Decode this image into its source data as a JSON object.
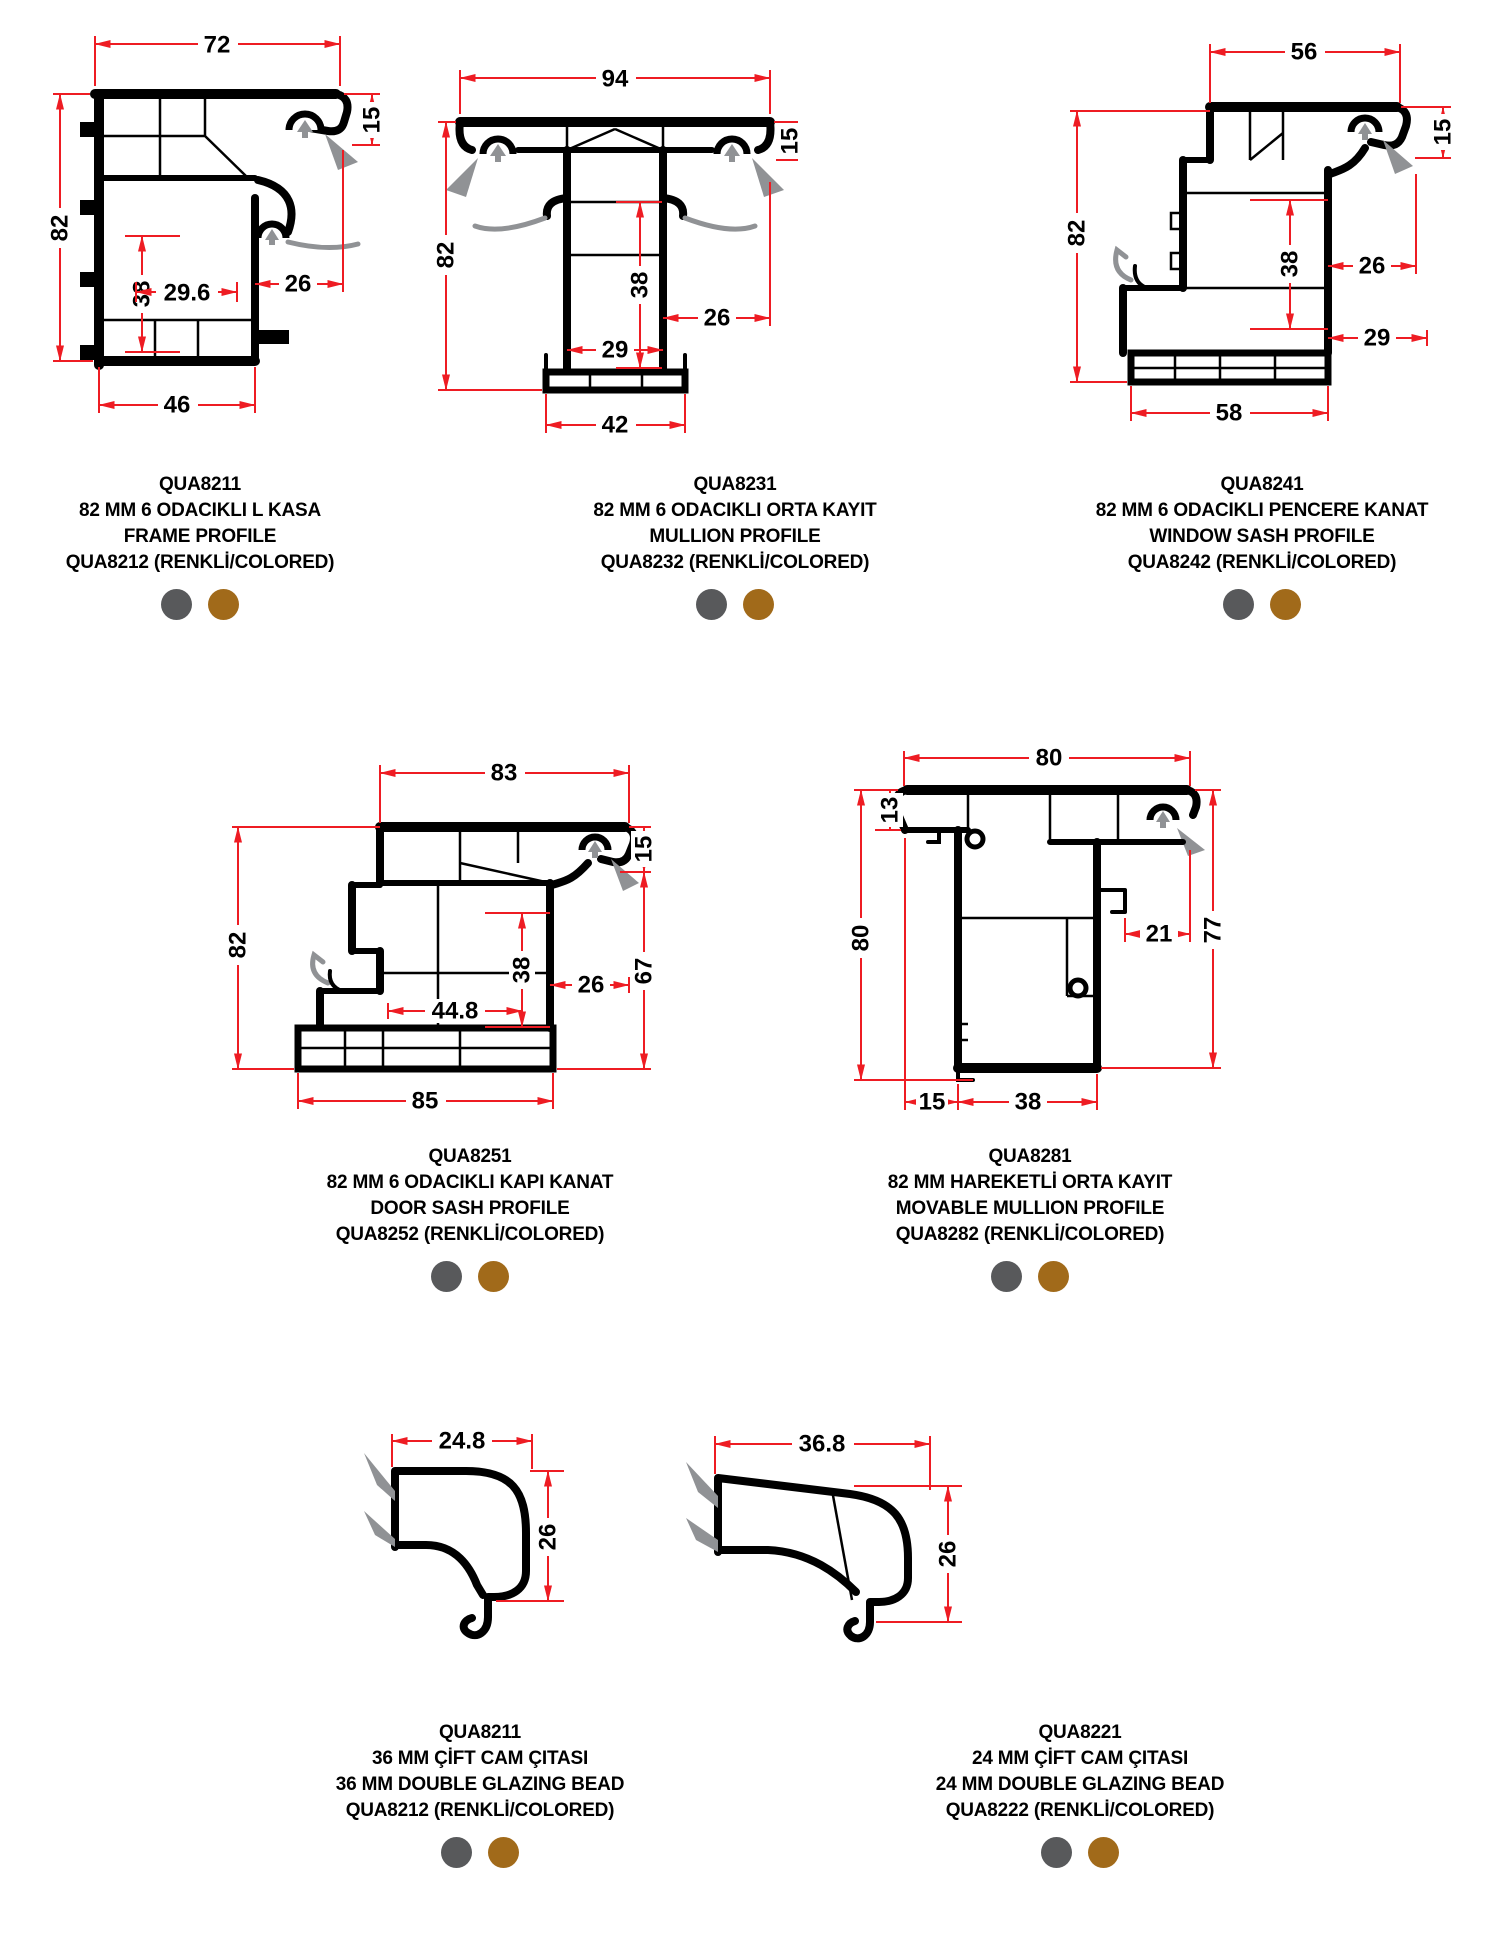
{
  "colors": {
    "dimension_red": "#ee1c23",
    "profile_black": "#000000",
    "gasket_gray": "#909295",
    "dot_gray": "#58595b",
    "dot_brown": "#a16a1a"
  },
  "color_options": {
    "gray": "RENKLİ gri",
    "brown": "RENKLİ kahverengi"
  },
  "profiles": [
    {
      "code": "QUA8211",
      "name_tr": "82 MM 6 ODACIKLI L KASA",
      "name_en": "FRAME PROFILE",
      "colored": "QUA8212 (RENKLİ/COLORED)",
      "dims": {
        "top": "72",
        "left": "82",
        "right_top": "15",
        "inner_v": "38",
        "inner_h": "29.6",
        "right": "26",
        "bottom": "46"
      }
    },
    {
      "code": "QUA8231",
      "name_tr": "82 MM 6 ODACIKLI ORTA KAYIT",
      "name_en": "MULLION PROFILE",
      "colored": "QUA8232 (RENKLİ/COLORED)",
      "dims": {
        "top": "94",
        "left": "82",
        "right_top": "15",
        "inner_v": "38",
        "inner_h": "29",
        "right": "26",
        "bottom": "42"
      }
    },
    {
      "code": "QUA8241",
      "name_tr": "82 MM 6 ODACIKLI PENCERE KANAT",
      "name_en": "WINDOW SASH PROFILE",
      "colored": "QUA8242 (RENKLİ/COLORED)",
      "dims": {
        "top": "56",
        "left": "82",
        "right_top": "15",
        "inner_v": "38",
        "inner_h": "29",
        "right": "26",
        "bottom": "58"
      }
    },
    {
      "code": "QUA8251",
      "name_tr": "82 MM 6 ODACIKLI KAPI KANAT",
      "name_en": "DOOR SASH PROFILE",
      "colored": "QUA8252 (RENKLİ/COLORED)",
      "dims": {
        "top": "83",
        "left": "82",
        "right_top": "15",
        "right_side": "67",
        "inner_v": "38",
        "inner_h": "44.8",
        "right": "26",
        "bottom": "85"
      }
    },
    {
      "code": "QUA8281",
      "name_tr": "82 MM HAREKETLİ ORTA KAYIT",
      "name_en": "MOVABLE MULLION PROFILE",
      "colored": "QUA8282 (RENKLİ/COLORED)",
      "dims": {
        "top": "80",
        "left_top": "13",
        "left": "80",
        "mid_right": "21",
        "right_side": "77",
        "bottom_left": "15",
        "bottom": "38"
      }
    },
    {
      "code": "QUA8211",
      "name_tr": "36 MM ÇİFT CAM ÇITASI",
      "name_en": "36 MM DOUBLE GLAZING BEAD",
      "colored": "QUA8212 (RENKLİ/COLORED)",
      "dims": {
        "top": "24.8",
        "right": "26"
      }
    },
    {
      "code": "QUA8221",
      "name_tr": "24 MM ÇİFT CAM ÇITASI",
      "name_en": "24 MM DOUBLE GLAZING BEAD",
      "colored": "QUA8222 (RENKLİ/COLORED)",
      "dims": {
        "top": "36.8",
        "right": "26"
      }
    }
  ]
}
